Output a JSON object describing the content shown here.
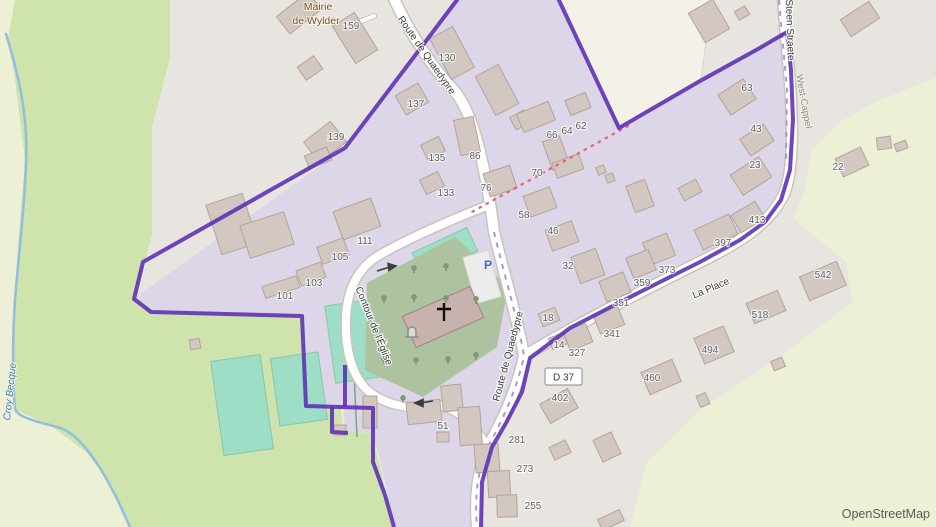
{
  "attribution": "OpenStreetMap",
  "place": {
    "mairie_line1": "Mairie",
    "mairie_line2": "de Wylder"
  },
  "water": {
    "stream_name": "Croy Becque"
  },
  "streets": {
    "route_de_quaedypre": "Route de Quaedypre",
    "contour_de_leglise": "Contour de l'Église",
    "la_place": "La Place",
    "steen_straete": "Steen Straete",
    "west_cappel": "West-Cappel",
    "d37_ref": "D 37"
  },
  "map_icons": {
    "parking": "P"
  },
  "house_numbers": [
    [
      "159",
      351,
      25
    ],
    [
      "130",
      447,
      57
    ],
    [
      "137",
      416,
      103
    ],
    [
      "139",
      336,
      136
    ],
    [
      "135",
      437,
      157
    ],
    [
      "133",
      446,
      192
    ],
    [
      "86",
      475,
      155
    ],
    [
      "76",
      486,
      187
    ],
    [
      "70",
      537,
      172
    ],
    [
      "66",
      552,
      134
    ],
    [
      "64",
      567,
      130
    ],
    [
      "62",
      581,
      125
    ],
    [
      "58",
      524,
      214
    ],
    [
      "46",
      553,
      230
    ],
    [
      "32",
      568,
      265
    ],
    [
      "111",
      365,
      240
    ],
    [
      "105",
      340,
      256
    ],
    [
      "103",
      314,
      282
    ],
    [
      "101",
      285,
      295
    ],
    [
      "63",
      747,
      87
    ],
    [
      "43",
      756,
      128
    ],
    [
      "23",
      755,
      164
    ],
    [
      "22",
      838,
      166
    ],
    [
      "413",
      757,
      219
    ],
    [
      "397",
      723,
      242
    ],
    [
      "373",
      667,
      269
    ],
    [
      "359",
      642,
      282
    ],
    [
      "351",
      621,
      302
    ],
    [
      "341",
      612,
      333
    ],
    [
      "327",
      577,
      352
    ],
    [
      "18",
      548,
      317
    ],
    [
      "14",
      559,
      344
    ],
    [
      "518",
      760,
      314
    ],
    [
      "494",
      710,
      349
    ],
    [
      "460",
      652,
      377
    ],
    [
      "542",
      823,
      274
    ],
    [
      "402",
      560,
      397
    ],
    [
      "51",
      443,
      425
    ],
    [
      "281",
      517,
      439
    ],
    [
      "273",
      525,
      468
    ],
    [
      "255",
      533,
      505
    ]
  ],
  "colors": {
    "farmland": "#eef0d5",
    "meadow": "#cfe3ad",
    "urban": "#e8e5e0",
    "residential": "#dcd6e8",
    "pitch": "#9edec6",
    "churchyard": "#adc3a0",
    "building": "#d3c7c1",
    "boundary": "#5b2db4",
    "water": "#92bfdc",
    "path_dots": "#dd6b7e"
  }
}
